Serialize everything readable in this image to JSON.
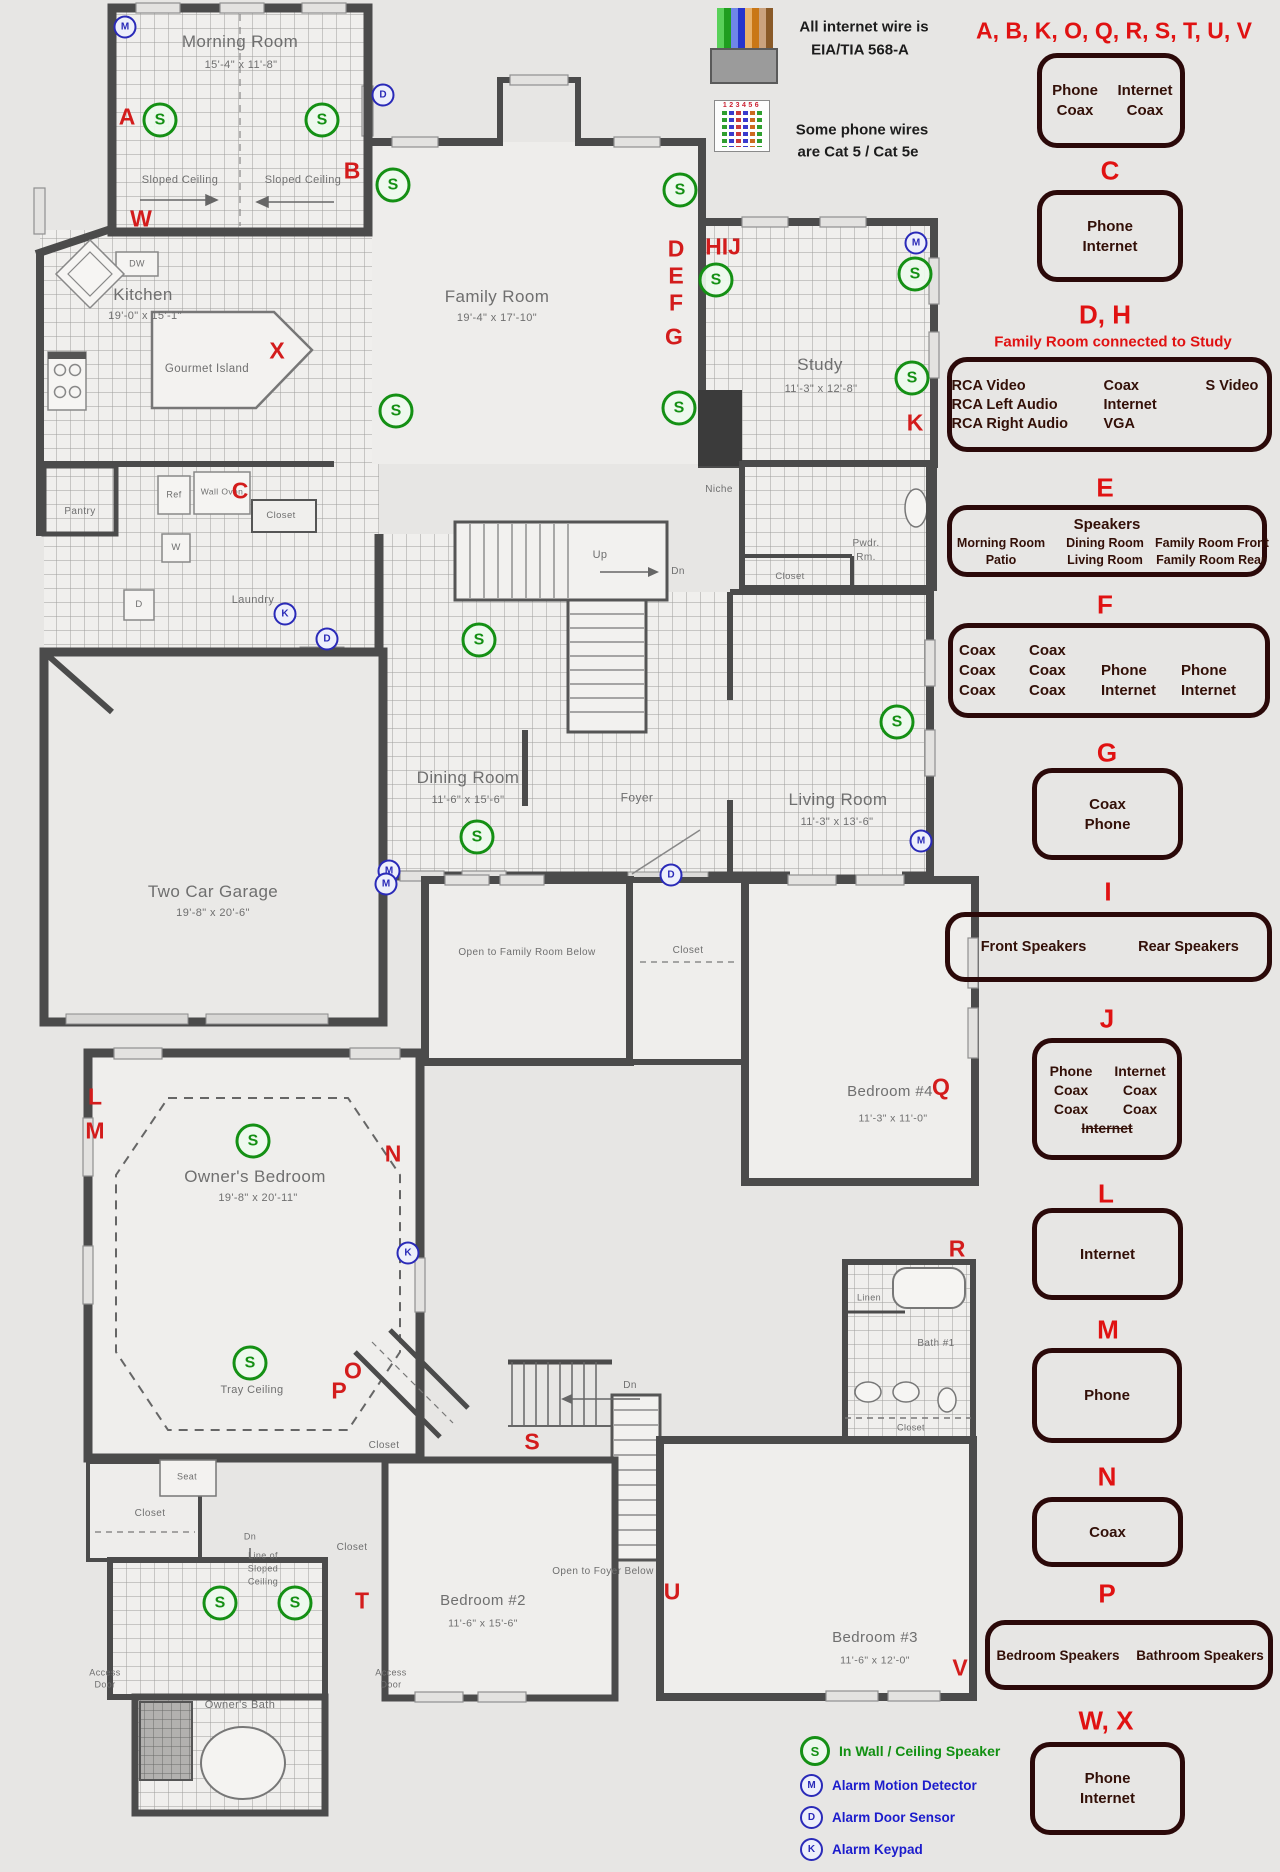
{
  "notes": {
    "internet_line1": "All internet wire is",
    "internet_line2": "EIA/TIA 568-A",
    "phone_line1": "Some phone wires",
    "phone_line2": "are Cat 5 / Cat 5e",
    "connector_digits": "123456"
  },
  "colors": {
    "red_letter": "#d31c1c",
    "legend_red": "#e01212",
    "speaker_green": "#149014",
    "alarm_blue": "#2a2ab8",
    "box_border": "#2b0909",
    "wall": "#4b4b4b",
    "background": "#e7e6e4"
  },
  "legend": {
    "header": "A, B, K, O, Q, R, S, T, U, V",
    "sections": [
      {
        "id": "abkoqrstuv",
        "l": "",
        "lx": 0,
        "ly": 0,
        "bx": 1037,
        "by": 53,
        "bw": 148,
        "bh": 95,
        "fs": 15,
        "rows": [
          [
            "Phone",
            "Internet"
          ],
          [
            "Coax",
            "Coax"
          ]
        ],
        "cw": [
          68,
          72
        ]
      },
      {
        "id": "c",
        "l": "C",
        "lx": 1110,
        "ly": 171,
        "bx": 1037,
        "by": 190,
        "bw": 146,
        "bh": 92,
        "fs": 15,
        "rows": [
          [
            "Phone"
          ],
          [
            "Internet"
          ]
        ]
      },
      {
        "id": "dh",
        "l": "D, H",
        "lx": 1105,
        "ly": 315,
        "sub": "Family Room connected to Study",
        "subx": 1113,
        "suby": 342,
        "bx": 947,
        "by": 357,
        "bw": 325,
        "bh": 95,
        "fs": 14.5,
        "align": "left",
        "rows": [
          [
            "RCA Video",
            "Coax",
            "S Video"
          ],
          [
            "RCA Left Audio",
            "Internet",
            ""
          ],
          [
            "RCA Right Audio",
            "VGA",
            ""
          ]
        ],
        "cw": [
          152,
          102,
          62
        ]
      },
      {
        "id": "e",
        "l": "E",
        "lx": 1105,
        "ly": 488,
        "bx": 947,
        "by": 505,
        "bw": 320,
        "bh": 72,
        "fs": 12.5,
        "title": "Speakers",
        "title_fs": 15,
        "rows": [
          [
            "Morning Room",
            "Dining Room",
            "Family Room Front"
          ],
          [
            "Patio",
            "Living Room",
            "Family Room Rear"
          ]
        ],
        "cw": [
          108,
          100,
          112
        ]
      },
      {
        "id": "f",
        "l": "F",
        "lx": 1105,
        "ly": 605,
        "bx": 948,
        "by": 623,
        "bw": 322,
        "bh": 95,
        "fs": 15,
        "align": "left",
        "rows": [
          [
            "Coax",
            "Coax",
            "",
            ""
          ],
          [
            "Coax",
            "Coax",
            "Phone",
            "Phone"
          ],
          [
            "Coax",
            "Coax",
            "Internet",
            "Internet"
          ]
        ],
        "cw": [
          70,
          72,
          80,
          78
        ]
      },
      {
        "id": "g",
        "l": "G",
        "lx": 1107,
        "ly": 753,
        "bx": 1032,
        "by": 768,
        "bw": 151,
        "bh": 92,
        "fs": 15,
        "rows": [
          [
            "Coax"
          ],
          [
            "Phone"
          ]
        ]
      },
      {
        "id": "i",
        "l": "I",
        "lx": 1108,
        "ly": 892,
        "bx": 945,
        "by": 912,
        "bw": 327,
        "bh": 70,
        "fs": 14.5,
        "rows": [
          [
            "Front Speakers",
            "Rear Speakers"
          ]
        ],
        "cw": [
          160,
          150
        ]
      },
      {
        "id": "j",
        "l": "J",
        "lx": 1107,
        "ly": 1019,
        "bx": 1032,
        "by": 1038,
        "bw": 150,
        "bh": 122,
        "fs": 14,
        "rows": [
          [
            "Phone",
            "Internet"
          ],
          [
            "Coax",
            "Coax"
          ],
          [
            "Coax",
            "Coax"
          ],
          [
            {
              "t": "Internet",
              "strike": true
            }
          ]
        ],
        "cw": [
          66,
          72
        ]
      },
      {
        "id": "l",
        "l": "L",
        "lx": 1106,
        "ly": 1194,
        "bx": 1032,
        "by": 1208,
        "bw": 151,
        "bh": 92,
        "fs": 15,
        "rows": [
          [
            "Internet"
          ]
        ]
      },
      {
        "id": "m",
        "l": "M",
        "lx": 1108,
        "ly": 1330,
        "bx": 1032,
        "by": 1348,
        "bw": 150,
        "bh": 95,
        "fs": 15,
        "rows": [
          [
            "Phone"
          ]
        ]
      },
      {
        "id": "n",
        "l": "N",
        "lx": 1107,
        "ly": 1477,
        "bx": 1032,
        "by": 1497,
        "bw": 151,
        "bh": 70,
        "fs": 15,
        "rows": [
          [
            "Coax"
          ]
        ]
      },
      {
        "id": "p",
        "l": "P",
        "lx": 1107,
        "ly": 1594,
        "bx": 985,
        "by": 1620,
        "bw": 288,
        "bh": 70,
        "fs": 13.5,
        "rows": [
          [
            "Bedroom Speakers",
            "Bathroom Speakers"
          ]
        ],
        "cw": [
          142,
          142
        ]
      },
      {
        "id": "wx",
        "l": "W, X",
        "lx": 1106,
        "ly": 1721,
        "bx": 1030,
        "by": 1742,
        "bw": 155,
        "bh": 93,
        "fs": 15,
        "rows": [
          [
            "Phone"
          ],
          [
            "Internet"
          ]
        ]
      }
    ]
  },
  "symbol_key": [
    {
      "sym": "S",
      "kind": "speaker",
      "label": "In Wall / Ceiling Speaker"
    },
    {
      "sym": "M",
      "kind": "alarm",
      "label": "Alarm Motion Detector"
    },
    {
      "sym": "D",
      "kind": "alarm",
      "label": "Alarm Door Sensor"
    },
    {
      "sym": "K",
      "kind": "alarm",
      "label": "Alarm Keypad"
    }
  ],
  "floor1": {
    "labels": [
      {
        "t": "Morning Room",
        "x": 240,
        "y": 42,
        "s": 17
      },
      {
        "t": "15'-4\" x 11'-8\"",
        "x": 241,
        "y": 66,
        "s": 11
      },
      {
        "t": "Sloped Ceiling",
        "x": 180,
        "y": 181,
        "s": 11
      },
      {
        "t": "Sloped Ceiling",
        "x": 303,
        "y": 181,
        "s": 11
      },
      {
        "t": "Kitchen",
        "x": 143,
        "y": 295,
        "s": 17
      },
      {
        "t": "19'-0\" x 15'-1\"",
        "x": 145,
        "y": 317,
        "s": 11
      },
      {
        "t": "DW",
        "x": 137,
        "y": 264,
        "s": 9
      },
      {
        "t": "Gourmet Island",
        "x": 207,
        "y": 369,
        "s": 11.5
      },
      {
        "t": "Family Room",
        "x": 497,
        "y": 297,
        "s": 17
      },
      {
        "t": "19'-4\" x 17'-10\"",
        "x": 497,
        "y": 319,
        "s": 11
      },
      {
        "t": "Study",
        "x": 820,
        "y": 365,
        "s": 17
      },
      {
        "t": "11'-3\" x 12'-8\"",
        "x": 821,
        "y": 390,
        "s": 11
      },
      {
        "t": "Niche",
        "x": 719,
        "y": 490,
        "s": 10
      },
      {
        "t": "Pwdr.",
        "x": 866,
        "y": 544,
        "s": 10
      },
      {
        "t": "Rm.",
        "x": 866,
        "y": 558,
        "s": 10
      },
      {
        "t": "Closet",
        "x": 790,
        "y": 577,
        "s": 9.5
      },
      {
        "t": "Wall Oven",
        "x": 222,
        "y": 492,
        "s": 8.5,
        "w": 44
      },
      {
        "t": "Ref",
        "x": 174,
        "y": 495,
        "s": 9
      },
      {
        "t": "Closet",
        "x": 281,
        "y": 516,
        "s": 9.5
      },
      {
        "t": "Pantry",
        "x": 80,
        "y": 512,
        "s": 10
      },
      {
        "t": "W",
        "x": 176,
        "y": 548,
        "s": 9.5
      },
      {
        "t": "D",
        "x": 139,
        "y": 605,
        "s": 9.5
      },
      {
        "t": "Laundry",
        "x": 253,
        "y": 601,
        "s": 11
      },
      {
        "t": "Up",
        "x": 600,
        "y": 556,
        "s": 11
      },
      {
        "t": "Dn",
        "x": 678,
        "y": 572,
        "s": 10
      },
      {
        "t": "Dining Room",
        "x": 468,
        "y": 778,
        "s": 17
      },
      {
        "t": "11'-6\" x 15'-6\"",
        "x": 468,
        "y": 801,
        "s": 11
      },
      {
        "t": "Foyer",
        "x": 637,
        "y": 798,
        "s": 12
      },
      {
        "t": "Living Room",
        "x": 838,
        "y": 800,
        "s": 17
      },
      {
        "t": "11'-3\" x 13'-6\"",
        "x": 837,
        "y": 823,
        "s": 11
      },
      {
        "t": "Two Car Garage",
        "x": 213,
        "y": 892,
        "s": 17
      },
      {
        "t": "19'-8\" x 20'-6\"",
        "x": 213,
        "y": 914,
        "s": 11
      }
    ],
    "letters": [
      {
        "t": "A",
        "x": 127,
        "y": 117
      },
      {
        "t": "B",
        "x": 352,
        "y": 171
      },
      {
        "t": "W",
        "x": 141,
        "y": 219
      },
      {
        "t": "X",
        "x": 277,
        "y": 351
      },
      {
        "t": "C",
        "x": 240,
        "y": 491
      },
      {
        "t": "D",
        "x": 676,
        "y": 249
      },
      {
        "t": "E",
        "x": 676,
        "y": 276
      },
      {
        "t": "F",
        "x": 676,
        "y": 303
      },
      {
        "t": "G",
        "x": 674,
        "y": 337
      },
      {
        "t": "HIJ",
        "x": 723,
        "y": 247
      },
      {
        "t": "K",
        "x": 915,
        "y": 423
      }
    ],
    "speakers": [
      [
        160,
        120
      ],
      [
        322,
        120
      ],
      [
        393,
        185
      ],
      [
        680,
        190
      ],
      [
        716,
        280
      ],
      [
        915,
        274
      ],
      [
        912,
        378
      ],
      [
        679,
        408
      ],
      [
        396,
        411
      ],
      [
        479,
        640
      ],
      [
        477,
        837
      ],
      [
        897,
        722
      ]
    ],
    "alarms": [
      {
        "t": "M",
        "x": 125,
        "y": 27
      },
      {
        "t": "M",
        "x": 916,
        "y": 243
      },
      {
        "t": "M",
        "x": 921,
        "y": 841
      },
      {
        "t": "M",
        "x": 389,
        "y": 871
      },
      {
        "t": "D",
        "x": 383,
        "y": 95
      },
      {
        "t": "D",
        "x": 327,
        "y": 639
      },
      {
        "t": "D",
        "x": 671,
        "y": 875
      },
      {
        "t": "K",
        "x": 285,
        "y": 614
      }
    ]
  },
  "floor2": {
    "labels": [
      {
        "t": "Open to Family Room Below",
        "x": 527,
        "y": 953,
        "s": 10
      },
      {
        "t": "Closet",
        "x": 688,
        "y": 951,
        "s": 10
      },
      {
        "t": "Bedroom #4",
        "x": 890,
        "y": 1092,
        "s": 15
      },
      {
        "t": "11'-3\" x 11'-0\"",
        "x": 893,
        "y": 1119,
        "s": 10.5
      },
      {
        "t": "Owner's Bedroom",
        "x": 255,
        "y": 1177,
        "s": 17
      },
      {
        "t": "19'-8\" x 20'-11\"",
        "x": 258,
        "y": 1199,
        "s": 11
      },
      {
        "t": "Tray Ceiling",
        "x": 252,
        "y": 1391,
        "s": 11
      },
      {
        "t": "Linen",
        "x": 869,
        "y": 1298,
        "s": 9
      },
      {
        "t": "Bath #1",
        "x": 936,
        "y": 1344,
        "s": 10
      },
      {
        "t": "Closet",
        "x": 911,
        "y": 1428,
        "s": 9
      },
      {
        "t": "Closet",
        "x": 384,
        "y": 1446,
        "s": 10
      },
      {
        "t": "Closet",
        "x": 150,
        "y": 1514,
        "s": 10
      },
      {
        "t": "Closet",
        "x": 352,
        "y": 1548,
        "s": 10
      },
      {
        "t": "Dn",
        "x": 250,
        "y": 1537,
        "s": 9
      },
      {
        "t": "Line of",
        "x": 263,
        "y": 1556,
        "s": 9
      },
      {
        "t": "Sloped",
        "x": 263,
        "y": 1569,
        "s": 9
      },
      {
        "t": "Ceiling",
        "x": 263,
        "y": 1582,
        "s": 9
      },
      {
        "t": "Seat",
        "x": 187,
        "y": 1477,
        "s": 9
      },
      {
        "t": "Dn",
        "x": 630,
        "y": 1386,
        "s": 10
      },
      {
        "t": "Bedroom #2",
        "x": 483,
        "y": 1601,
        "s": 15
      },
      {
        "t": "11'-6\" x 15'-6\"",
        "x": 483,
        "y": 1624,
        "s": 10.5
      },
      {
        "t": "Open to Foyer Below",
        "x": 603,
        "y": 1572,
        "s": 10
      },
      {
        "t": "Bedroom #3",
        "x": 875,
        "y": 1638,
        "s": 15
      },
      {
        "t": "11'-6\" x 12'-0\"",
        "x": 875,
        "y": 1661,
        "s": 10.5
      },
      {
        "t": "Owner's Bath",
        "x": 240,
        "y": 1706,
        "s": 11
      },
      {
        "t": "Access",
        "x": 105,
        "y": 1673,
        "s": 9
      },
      {
        "t": "Door",
        "x": 105,
        "y": 1685,
        "s": 9
      },
      {
        "t": "Access",
        "x": 391,
        "y": 1673,
        "s": 9
      },
      {
        "t": "Door",
        "x": 391,
        "y": 1685,
        "s": 9
      }
    ],
    "letters": [
      {
        "t": "L",
        "x": 95,
        "y": 1097
      },
      {
        "t": "M",
        "x": 95,
        "y": 1131
      },
      {
        "t": "N",
        "x": 393,
        "y": 1154
      },
      {
        "t": "O",
        "x": 353,
        "y": 1371
      },
      {
        "t": "P",
        "x": 339,
        "y": 1391
      },
      {
        "t": "Q",
        "x": 941,
        "y": 1087
      },
      {
        "t": "R",
        "x": 957,
        "y": 1249
      },
      {
        "t": "S",
        "x": 532,
        "y": 1442
      },
      {
        "t": "T",
        "x": 362,
        "y": 1601
      },
      {
        "t": "U",
        "x": 672,
        "y": 1592
      },
      {
        "t": "V",
        "x": 960,
        "y": 1668
      }
    ],
    "speakers": [
      [
        253,
        1141
      ],
      [
        250,
        1363
      ],
      [
        220,
        1603
      ],
      [
        295,
        1603
      ]
    ],
    "alarms": [
      {
        "t": "M",
        "x": 386,
        "y": 884
      },
      {
        "t": "K",
        "x": 408,
        "y": 1253
      }
    ]
  }
}
